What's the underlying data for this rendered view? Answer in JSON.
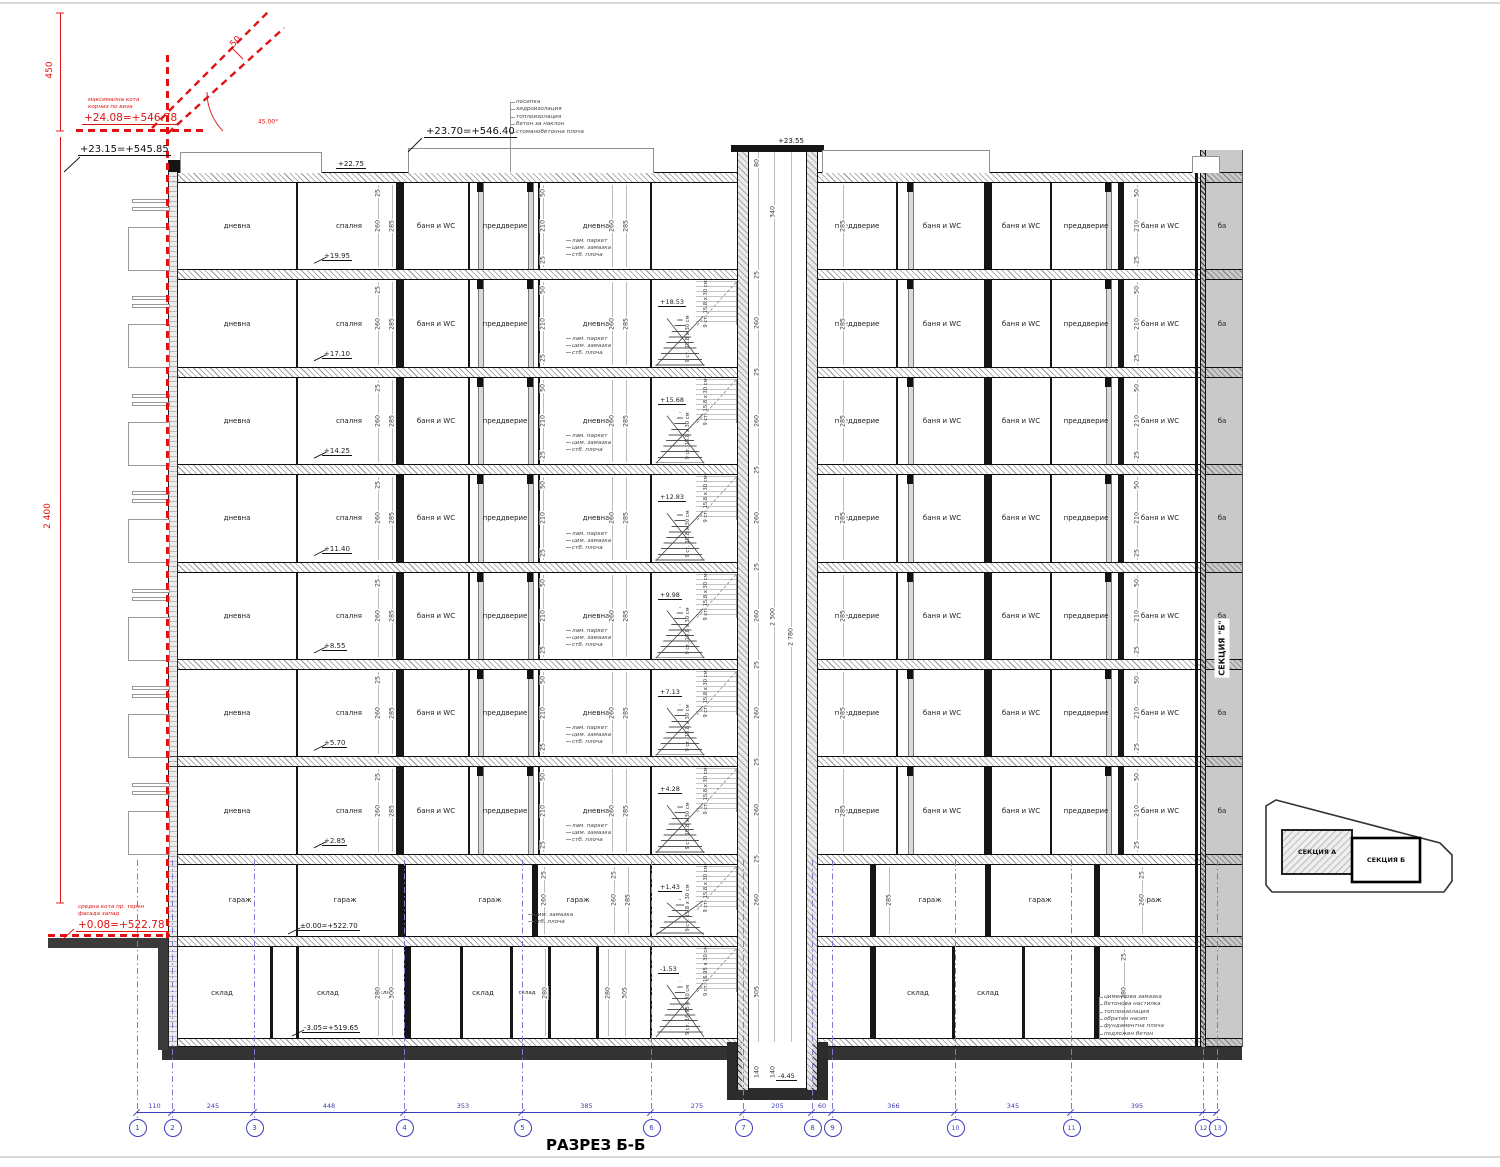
{
  "title": "РАЗРЕЗ Б-Б",
  "red": {
    "dim450": "450",
    "dim50": "50",
    "angle": "45.00°",
    "max_note1": "максимална кота",
    "max_note2": "корниз по виза",
    "max_elev": "+24.08=+546.78",
    "dim2400": "2 400",
    "terr_note1": "средна кота пр. терен",
    "terr_note2": "фасада запад",
    "terr_elev": "+0.08=+522.78"
  },
  "levels": {
    "parapet_left": "+23.15=+545.85",
    "roof_parapet": "+23.70=+546.40",
    "shaft_top": "+23.55",
    "roof_slab": "+22.75"
  },
  "floors": [
    {
      "elev": "+19.95"
    },
    {
      "elev": "+17.10",
      "stair": "+18.53"
    },
    {
      "elev": "+14.25",
      "stair": "+15.68"
    },
    {
      "elev": "+11.40",
      "stair": "+12.83"
    },
    {
      "elev": "+8.55",
      "stair": "+9.98"
    },
    {
      "elev": "+5.70",
      "stair": "+7.13"
    },
    {
      "elev": "+2.85",
      "stair": "+4.28"
    }
  ],
  "garage": {
    "label": "гараж",
    "elev": "±0.00=+522.70",
    "stair": "+1.43"
  },
  "basement": {
    "label": "склад",
    "elev": "-3.05=+519.65",
    "stair": "-1.53",
    "pit": "-4.45"
  },
  "rooms_left": [
    "дневна",
    "спалня",
    "баня и WC",
    "преддверие",
    "дневна"
  ],
  "rooms_right": [
    "преддверие",
    "баня и WC",
    "баня и WC",
    "преддверие",
    "баня и WC"
  ],
  "room_partial": "ба",
  "stair_note": "9 ст. 15.8 х 30 см",
  "stair_note_basement": "9 ст. 16.95 х 30 см",
  "notes": {
    "roof": [
      "посипка",
      "хидроизолация",
      "топлоизолация",
      "бетон за наклон",
      "стоманобетонна плоча"
    ],
    "floor": [
      "лам. паркет",
      "цим. замазка",
      "стб. плоча"
    ],
    "garage": [
      "цим. замазка",
      "стб. плоча"
    ],
    "foundation": [
      "циментова замазка",
      "бетонова настилка",
      "топлоизолация",
      "обратен насип",
      "фундаментна плоча",
      "подложен бетон"
    ]
  },
  "dims": {
    "d25": "25",
    "d50": "50",
    "d80": "80",
    "d140": "140",
    "d210": "210",
    "d260": "260",
    "d280": "280",
    "d285": "285",
    "d300": "300",
    "d305": "305",
    "d340": "340",
    "d2780": "2 780",
    "d2300": "2 300"
  },
  "grid": {
    "bubbles": [
      "1",
      "2",
      "3",
      "4",
      "5",
      "6",
      "7",
      "8",
      "9",
      "10",
      "11",
      "12",
      "13"
    ],
    "dims": [
      "110",
      "245",
      "448",
      "353",
      "385",
      "275",
      "205",
      "60",
      "366",
      "345",
      "395"
    ]
  },
  "keyplan": {
    "a": "СЕКЦИЯ А",
    "b": "СЕКЦИЯ Б"
  },
  "strip_label": "СЕКЦИЯ \"Б\""
}
